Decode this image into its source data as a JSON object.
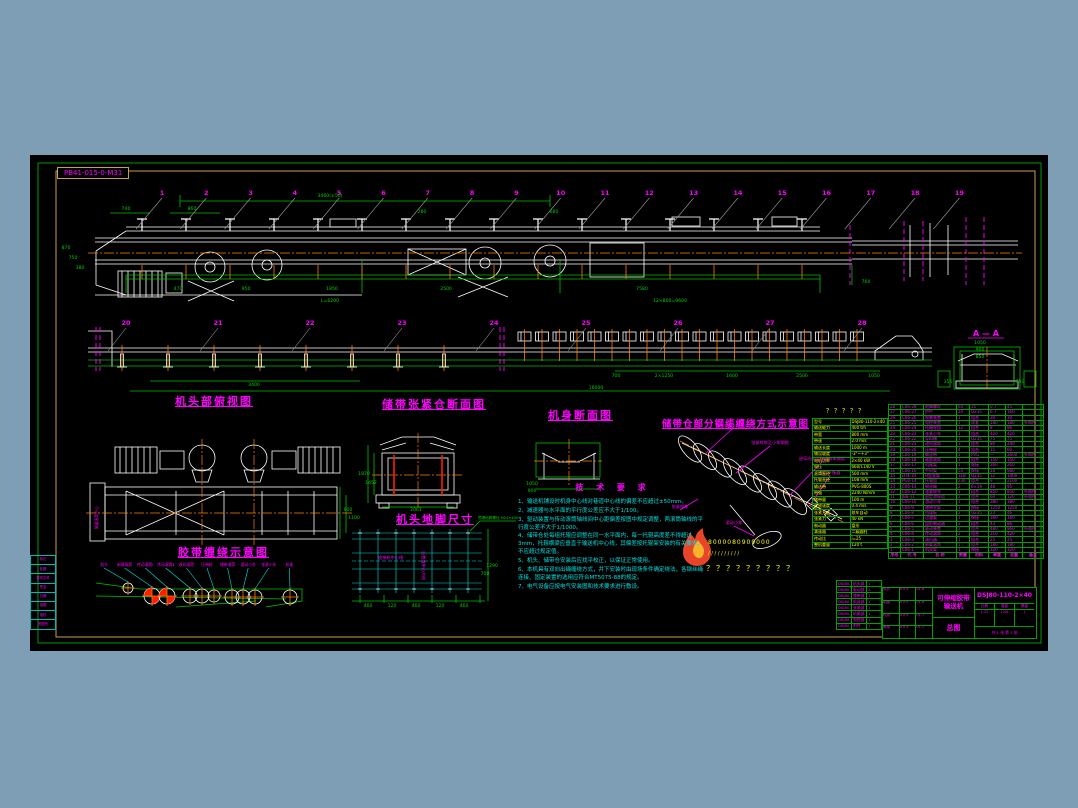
{
  "meta": {
    "drawing_label": "PB41-015-0-M31"
  },
  "colors": {
    "background": "#7E9EB6",
    "canvas": "#000000",
    "grid_green": "#00C000",
    "border_tan": "#C8A050",
    "magenta": "#FF00FF",
    "cyan": "#00E0E0",
    "orange": "#FF7F00",
    "yellow": "#FFFF00",
    "red": "#FF1E00",
    "white": "#FFFFFF"
  },
  "titles": {
    "head_plan": "机头部俯视图",
    "tension_section": "储带张紧仓断面图",
    "body_section": "机身断面图",
    "cable_winding": "储带仓部分钢缆缠绕方式示意图",
    "head_anchor": "机头地脚尺寸",
    "belt_winding": "胶带缠绕示意图",
    "section_aa": "A — A"
  },
  "callouts": {
    "top": [
      "1",
      "2",
      "3",
      "4",
      "5",
      "6",
      "7",
      "8",
      "9",
      "10",
      "11",
      "12",
      "13",
      "14",
      "15",
      "16",
      "17",
      "18",
      "19"
    ],
    "mid": [
      "20",
      "21",
      "22",
      "23",
      "24",
      "25",
      "26",
      "27",
      "28"
    ]
  },
  "dims": [
    [
      300,
      42,
      "3460(±50)"
    ],
    [
      96,
      55,
      "740"
    ],
    [
      162,
      55,
      "860"
    ],
    [
      392,
      58,
      "280"
    ],
    [
      524,
      58,
      "680"
    ],
    [
      36,
      94,
      "870"
    ],
    [
      43,
      104,
      "750"
    ],
    [
      50,
      114,
      "380"
    ],
    [
      148,
      135,
      "470"
    ],
    [
      216,
      135,
      "950"
    ],
    [
      302,
      135,
      "1850"
    ],
    [
      416,
      135,
      "2500"
    ],
    [
      612,
      135,
      "7580"
    ],
    [
      836,
      128,
      "760"
    ],
    [
      300,
      147,
      "L=6200"
    ],
    [
      640,
      147,
      "12×800=9600"
    ],
    [
      224,
      231,
      "3400"
    ],
    [
      586,
      222,
      "700"
    ],
    [
      634,
      222,
      "2×1250"
    ],
    [
      702,
      222,
      "1600"
    ],
    [
      772,
      222,
      "2500"
    ],
    [
      844,
      222,
      "1050"
    ],
    [
      566,
      234,
      "16000"
    ],
    [
      950,
      189,
      "1050"
    ],
    [
      950,
      196,
      "900"
    ],
    [
      950,
      203,
      "850"
    ],
    [
      918,
      228,
      "350"
    ],
    [
      990,
      228,
      "350"
    ],
    [
      318,
      356,
      "900"
    ],
    [
      324,
      364,
      "1100"
    ],
    [
      334,
      320,
      "1870"
    ],
    [
      341,
      329,
      "1452"
    ],
    [
      386,
      356,
      "2061"
    ],
    [
      502,
      330,
      "1050"
    ],
    [
      502,
      337,
      "900"
    ],
    [
      338,
      452,
      "460"
    ],
    [
      362,
      452,
      "120"
    ],
    [
      386,
      452,
      "460"
    ],
    [
      410,
      452,
      "120"
    ],
    [
      434,
      452,
      "460"
    ],
    [
      462,
      412,
      "1290"
    ],
    [
      455,
      420,
      "700"
    ]
  ],
  "notes": {
    "heading": "技 术 要 求",
    "items": [
      "1、输送机铺设时机身中心线对巷道中心线的偏差不应超过±50mm。",
      "2、减速器与水平面的平行度公差应不大于1/100。",
      "3、驱动装置与传动滚筒轴线间中心距偏差按图中规定调整，两滚筒轴线的平行度公差不大于1/1000。",
      "4、储带仓处每组托辊应调整在同一水平面内，每一托辊高度差不得超过3mm，托辊横梁应垂直于输送机中心线，其偏差按托辊架安装的有关要求，不应超过规定值。",
      "5、机头、储带仓安装后应找平校正，以保证正常使用。",
      "6、本机具有双向出绳缠绕方式，井下安装时由现场条件确定绕法，各钢丝绳连接、固定装置的选用应符合MT5075-88的规定。",
      "7、电气设备应按电气安装图和技术要求进行敷设。"
    ]
  },
  "labels": {
    "cable": [
      "储带小车上升方向",
      "张紧绞车至小车钢缆",
      "经导向轮至张紧绞车钢缆",
      "张力平衡器",
      "张紧绞车",
      "游动小车"
    ],
    "belt_winding": [
      "机头",
      "卸载滚筒",
      "传动滚筒Ⅰ",
      "传动滚筒Ⅱ",
      "改向滚筒",
      "压带轮",
      "储带滚筒",
      "游动小车",
      "张紧小车",
      "机尾"
    ],
    "anchor_center": "皮带机中心线",
    "anchor_vertical": "沿巷道中心方向",
    "anchor_bolt": "预埋地脚螺栓 M24×400",
    "head_left": "卸载滚筒中心"
  },
  "watermark": {
    "row1": "8000080909000",
    "row2": "/ / / / / / / / / /",
    "row3": "？？？？？？？？？"
  },
  "param_table": {
    "caption": "？？？？？",
    "rows": [
      [
        "型号",
        "DSJ80-110-2×40"
      ],
      [
        "输送能力",
        "400 t/h"
      ],
      [
        "带宽",
        "800 mm"
      ],
      [
        "带速",
        "2.0 m/s"
      ],
      [
        "输送长度",
        "1000 m"
      ],
      [
        "铺设坡度",
        "-3°~+3°"
      ],
      [
        "电机功率",
        "2×40 kW"
      ],
      [
        "电压",
        "660/1140 V"
      ],
      [
        "滚筒直径",
        "500 mm"
      ],
      [
        "托辊直径",
        "108 mm"
      ],
      [
        "输送带",
        "PVG-800S"
      ],
      [
        "带强",
        "2240 N/mm"
      ],
      [
        "储带量",
        "100 m"
      ],
      [
        "收放速度",
        "0.4 m/s"
      ],
      [
        "张紧方式",
        "绞车自动"
      ],
      [
        "张紧力",
        "40 kN"
      ],
      [
        "制动器",
        "盘形"
      ],
      [
        "减速器",
        "二级圆柱"
      ],
      [
        "传动比",
        "i=25"
      ],
      [
        "整机重量",
        "120 t"
      ]
    ]
  },
  "bom": {
    "headers": [
      "序号",
      "代 号",
      "名 称",
      "数量",
      "材料",
      "单重",
      "总重",
      "备注"
    ],
    "rows": [
      [
        "28",
        "C06-28",
        "地脚螺栓",
        "64",
        "35",
        "0.7",
        "45",
        ""
      ],
      [
        "27",
        "C06-27",
        "护栏",
        "24",
        "Q235",
        "6.7",
        "160",
        ""
      ],
      [
        "26",
        "C06-26",
        "喷雾装置",
        "1",
        "组合",
        "30",
        "30",
        ""
      ],
      [
        "25",
        "C06-25",
        "电控装置",
        "1",
        "成套",
        "180",
        "180",
        "外购件"
      ],
      [
        "24",
        "C06-24",
        "托绳轮组",
        "12",
        "组合",
        "8",
        "96",
        ""
      ],
      [
        "23",
        "C06-23",
        "张紧小车",
        "1",
        "组合",
        "420",
        "420",
        ""
      ],
      [
        "22",
        "C06-22",
        "导料槽",
        "1",
        "Q235",
        "75",
        "75",
        ""
      ],
      [
        "21",
        "C06-21",
        "改向滚筒",
        "3",
        "组合",
        "80",
        "240",
        ""
      ],
      [
        "20",
        "C06-20",
        "压带轮",
        "4",
        "组合",
        "15",
        "60",
        ""
      ],
      [
        "19",
        "C06-19",
        "输送带",
        "1",
        "PVG",
        "—",
        "3600",
        "外购件"
      ],
      [
        "18",
        "C06-18",
        "尾部滚筒",
        "1",
        "组合",
        "150",
        "150",
        ""
      ],
      [
        "17",
        "C06-17",
        "机尾架",
        "1",
        "焊接",
        "260",
        "260",
        ""
      ],
      [
        "16",
        "C06-16",
        "中间架",
        "54",
        "焊接",
        "18",
        "980",
        ""
      ],
      [
        "15",
        "DTⅡ-10",
        "H型支架",
        "118",
        "Q235",
        "12",
        "1400",
        ""
      ],
      [
        "14",
        "PG0-14",
        "托辊组",
        "236",
        "组合",
        "9",
        "2100",
        ""
      ],
      [
        "13",
        "C06-13",
        "钢丝绳",
        "2",
        "6×19",
        "48",
        "95",
        ""
      ],
      [
        "12",
        "C06-12",
        "张紧绞车",
        "1",
        "组合",
        "850",
        "850",
        "外购件"
      ],
      [
        "11",
        "JB8-11",
        "固定滑轮组",
        "2",
        "组合",
        "60",
        "120",
        "外购件"
      ],
      [
        "10",
        "C06-10",
        "游动小车",
        "1",
        "组合",
        "380",
        "380",
        ""
      ],
      [
        "9",
        "C06-9",
        "储带仓架",
        "1",
        "焊接",
        "1250",
        "1250",
        ""
      ],
      [
        "8",
        "C06-8",
        "挡煤板",
        "2",
        "Q235",
        "23",
        "46",
        ""
      ],
      [
        "7",
        "C06-7",
        "过渡架",
        "1",
        "焊接",
        "160",
        "160",
        ""
      ],
      [
        "6",
        "C06-6",
        "盘形制动器",
        "2",
        "组合",
        "43",
        "86",
        ""
      ],
      [
        "5",
        "C06-5",
        "驱动装置",
        "2",
        "组合",
        "480",
        "960",
        "外购件"
      ],
      [
        "4",
        "C06-4",
        "传动滚筒",
        "2",
        "组合",
        "210",
        "420",
        ""
      ],
      [
        "3",
        "C06-3",
        "清扫器",
        "1",
        "组合",
        "25",
        "25",
        ""
      ],
      [
        "2",
        "C06-2",
        "卸载滚筒",
        "1",
        "组合",
        "180",
        "180",
        ""
      ],
      [
        "1",
        "C06-1",
        "机头架",
        "1",
        "焊接",
        "320",
        "320",
        ""
      ]
    ]
  },
  "sub_drawings": [
    [
      "DSJ80-1",
      "机头部",
      "1"
    ],
    [
      "DSJ80-2",
      "驱动部",
      "2"
    ],
    [
      "DSJ80-3",
      "储带部",
      "1"
    ],
    [
      "DSJ80-4",
      "机身部",
      "1"
    ],
    [
      "DSJ80-5",
      "张紧部",
      "1"
    ],
    [
      "DSJ80-6",
      "机尾部",
      "1"
    ],
    [
      "DSJ80-7",
      "电控部",
      "1"
    ],
    [
      "DSJ80-8",
      "附件",
      "1"
    ]
  ],
  "left_strip": [
    "标记",
    "处数",
    "更改文件",
    "签名",
    "日期",
    "描图",
    "描校",
    "底图号"
  ],
  "title_block": {
    "product_line1": "可伸缩胶带",
    "product_line2": "输送机",
    "sheet_type": "总图",
    "drawing_no": "DSJ80-110-2×40",
    "fields": [
      [
        "设计",
        "×××",
        "01.6"
      ],
      [
        "制图",
        "×××",
        "01.6"
      ],
      [
        "校对",
        "×××",
        "01.7"
      ],
      [
        "审核",
        "×××",
        "01.7"
      ]
    ],
    "cells": [
      [
        "比例",
        "1:25"
      ],
      [
        "重量",
        "120t"
      ],
      [
        "数量",
        "1"
      ]
    ],
    "sheet_note": "共 1 张 第 1 张"
  }
}
